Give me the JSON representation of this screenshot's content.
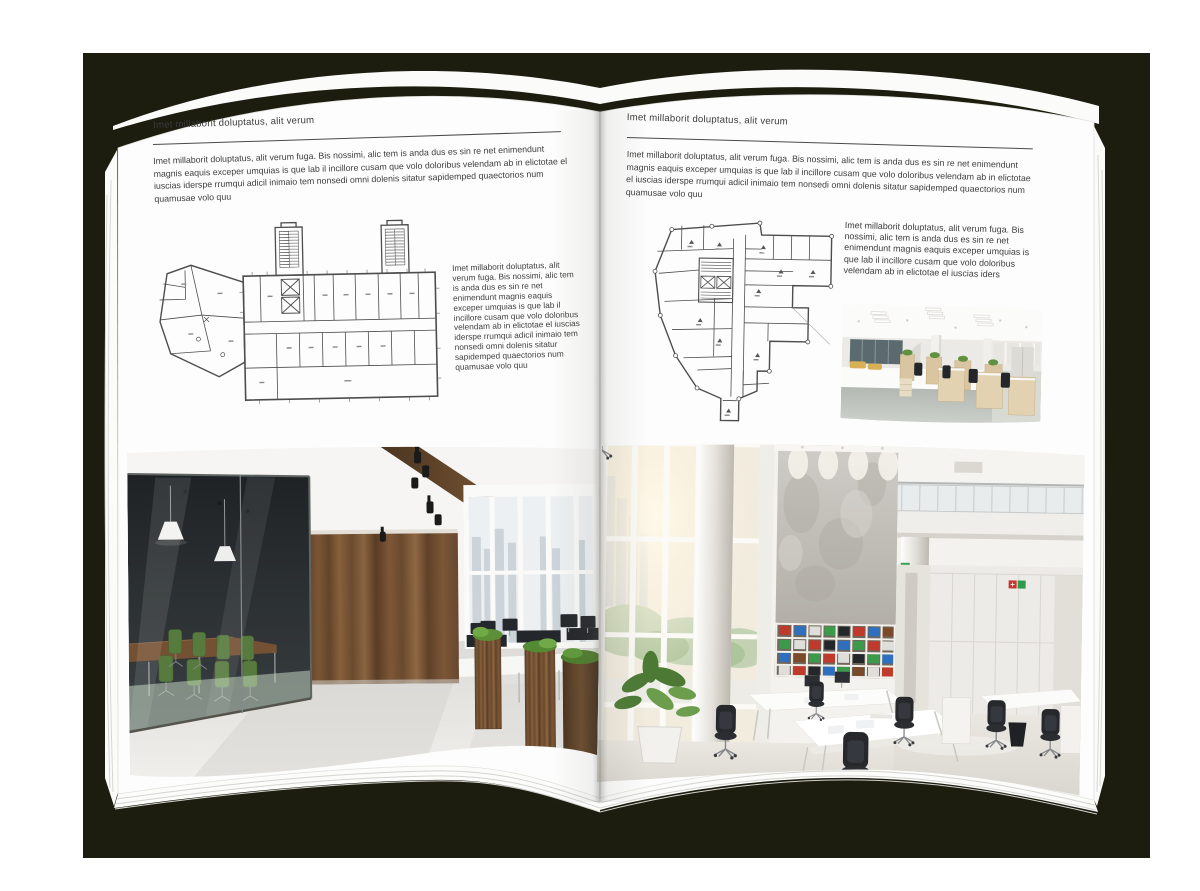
{
  "palette": {
    "backdrop": "#1c1c0f",
    "page": "#fdfdfd",
    "text": "#3d3d3d",
    "rule": "#4a4a4a",
    "plan_line": "#4d4d4d",
    "wood": "#6e4b2e",
    "chair_green": "#4f7434",
    "plant_green": "#5a8a41",
    "binder_colors": [
      "#bf3a2b",
      "#2f6fc0",
      "#3b9b4b",
      "#dfdedb",
      "#7a4a2a",
      "#23272c"
    ]
  },
  "left_page": {
    "header": "Imet millaborit doluptatus, alit verum",
    "intro": "Imet millaborit doluptatus, alit verum fuga. Bis nossimi, alic tem is anda dus es sin re net enimendunt magnis eaquis exceper umquias is que lab il incillore cusam que volo doloribus velendam ab in elictotae el iuscias iderspe rrumqui adicil inimaio tem nonsedi omni dolenis sitatur sapidemped quaectorios num quamusae volo quu",
    "side_text": "Imet millaborit doluptatus, alit verum fuga. Bis nossimi, alic tem is anda dus es sin re net enimendunt magnis eaquis exceper umquias is que lab il incillore cusam que volo doloribus velendam ab in elictotae el iuscias iderspe rrumqui adicil inimaio tem nonsedi omni dolenis sitatur sapidemped quaectorios num quamusae volo quu",
    "floor_plan_description": "Floor plan of an elongated office block with two stair towers and an angled west wing",
    "photo_description": "Loft-style office interior with glass-walled meeting room, green chairs, dark wood feature wall, ceiling spotlights and planter-divided workstations"
  },
  "right_page": {
    "header": "Imet millaborit doluptatus, alit verum",
    "intro": "Imet millaborit doluptatus, alit verum fuga. Bis nossimi, alic tem is anda dus es sin re net enimendunt magnis eaquis exceper umquias is que lab il incillore cusam que volo doloribus velendam ab in elictotae el iuscias iderspe rrumqui adicil inimaio tem nonsedi omni dolenis sitatur sapidemped quaectorios num quamusae volo quu",
    "side_text": "Imet millaborit doluptatus, alit verum fuga. Bis nossimi, alic tem is anda dus es sin re net enimendunt magnis eaquis exceper umquias is que lab il incillore cusam que volo doloribus velendam ab in elictotae el iuscias iders",
    "floor_plan_description": "Floor plan of an irregular corner building tapering to a southern wing",
    "small_photo_description": "Open-plan office with white workstations, light oak cabinets, black task chairs and slatted panel lighting",
    "photo_description": "Bright double-height office hall with glazed facade, concrete feature wall, shelving with colored binders, white desks and black chairs"
  }
}
